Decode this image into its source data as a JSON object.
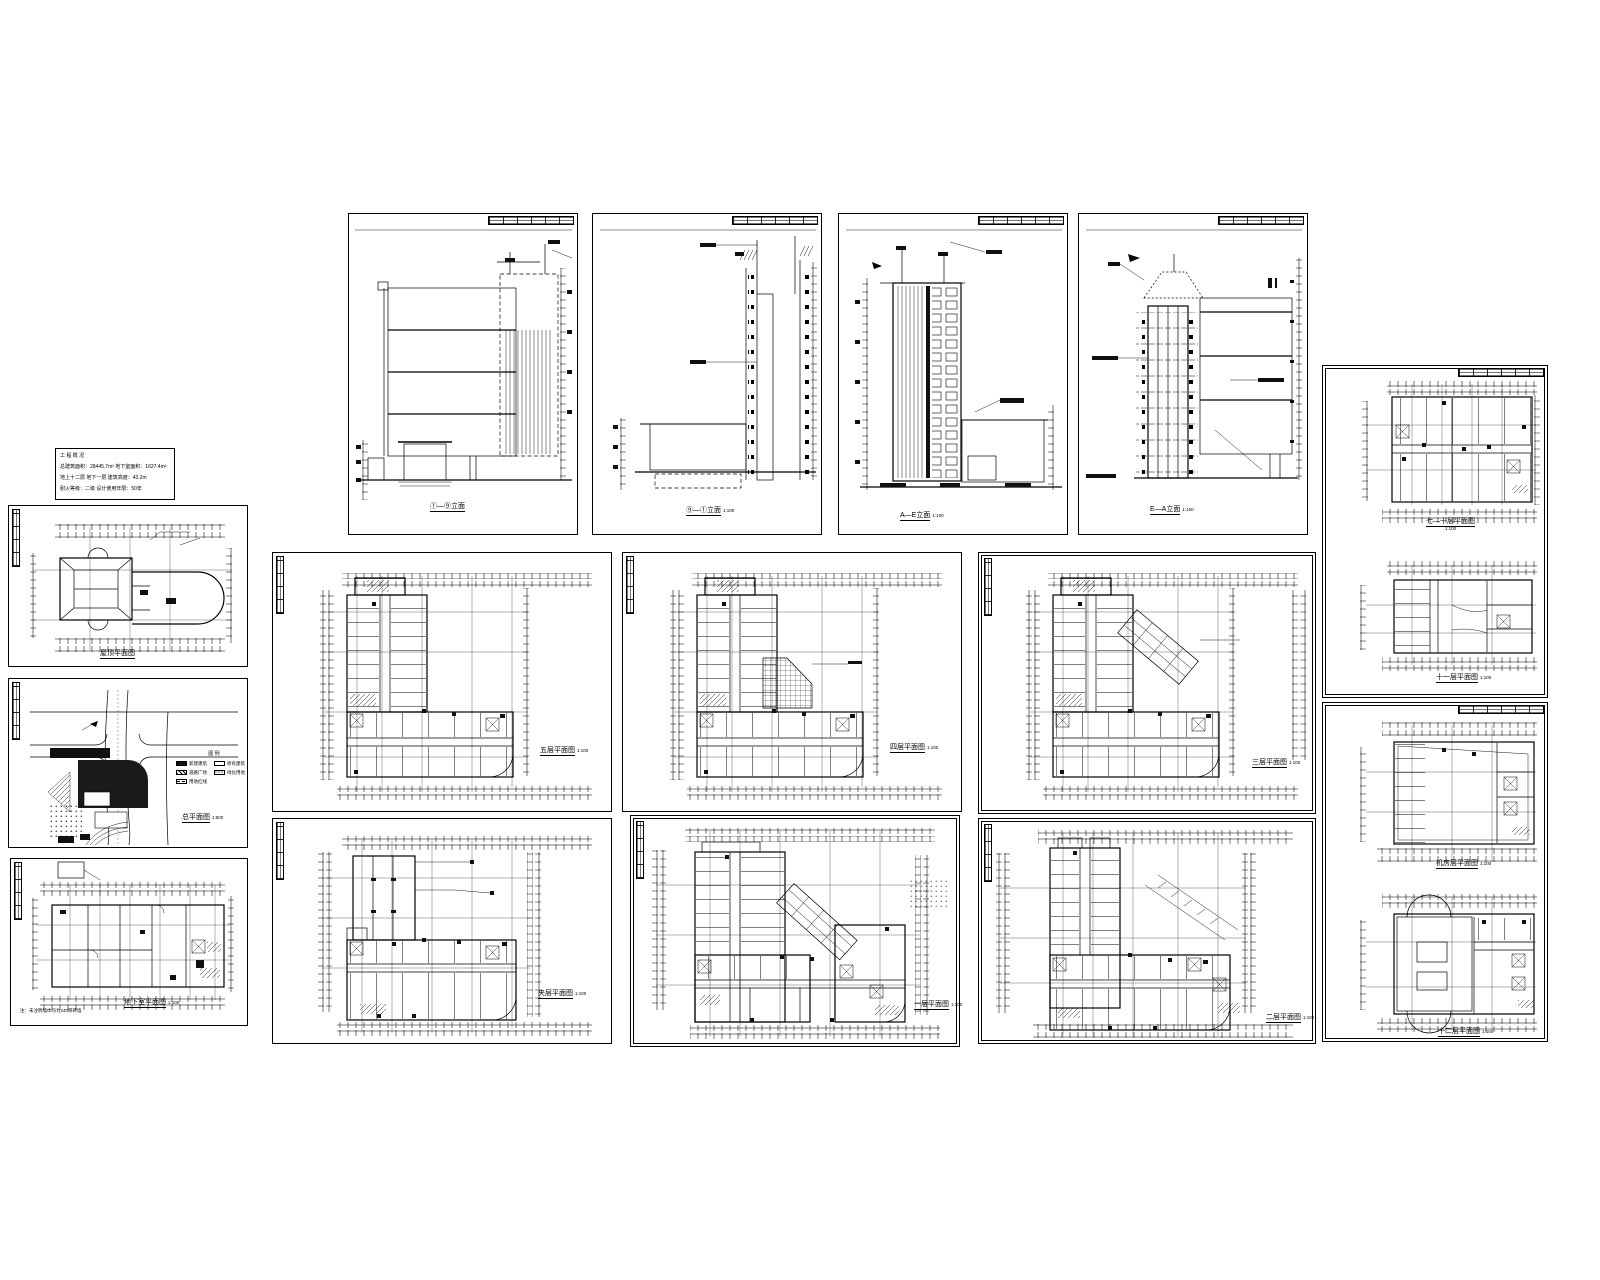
{
  "document": {
    "kind": "architectural-cad-drawing-set",
    "paper_color": "#ffffff",
    "line_color": "#000000"
  },
  "note_box": {
    "lines": [
      "工 程 概 况",
      "总建筑面积：28445.7m²  地下室面积：1627.4m²",
      "地上十二层  地下一层  建筑高度：43.2m",
      "耐火等级：二级  设计使用年限：50年"
    ]
  },
  "sheets": [
    {
      "id": "roof-plan",
      "caption": "屋顶平面图",
      "scale": ""
    },
    {
      "id": "site-plan",
      "caption": "总平面图",
      "scale": "1:500"
    },
    {
      "id": "basement-plan",
      "caption": "地下室平面图",
      "scale": "1:100"
    },
    {
      "id": "elevation-1",
      "caption": "①—⑨立面",
      "scale": ""
    },
    {
      "id": "elevation-2",
      "caption": "⑨—①立面",
      "scale": "1:100"
    },
    {
      "id": "elevation-3",
      "caption": "A—E立面",
      "scale": "1:100"
    },
    {
      "id": "elevation-4",
      "caption": "E—A立面",
      "scale": "1:100"
    },
    {
      "id": "plan-5f",
      "caption": "五层平面图",
      "scale": "1:100"
    },
    {
      "id": "plan-4f",
      "caption": "四层平面图",
      "scale": "1:100"
    },
    {
      "id": "plan-3f",
      "caption": "三层平面图",
      "scale": "1:100"
    },
    {
      "id": "plan-mezzanine",
      "caption": "夹层平面图",
      "scale": "1:100"
    },
    {
      "id": "plan-1f",
      "caption": "一层平面图",
      "scale": "1:100"
    },
    {
      "id": "plan-2f",
      "caption": "二层平面图",
      "scale": "1:100"
    },
    {
      "id": "plans-upper",
      "caption": "七—十层平面图",
      "scale": "1:100",
      "caption2": "十一层平面图",
      "scale2": "1:100"
    },
    {
      "id": "plans-top",
      "caption": "机房层平面图",
      "scale": "1:100",
      "caption2": "十二层平面图",
      "scale2": "1:100"
    }
  ],
  "site_legend": {
    "title": "图 例",
    "items": [
      {
        "label": "新建建筑",
        "swatch": "solid"
      },
      {
        "label": "原有建筑",
        "swatch": "outline"
      },
      {
        "label": "道路广场",
        "swatch": "hatch"
      },
      {
        "label": "绿化用地",
        "swatch": "dots"
      },
      {
        "label": "用地红线",
        "swatch": "dash"
      }
    ]
  },
  "basement_note": "注：未注明墙体均为240厚砖墙"
}
